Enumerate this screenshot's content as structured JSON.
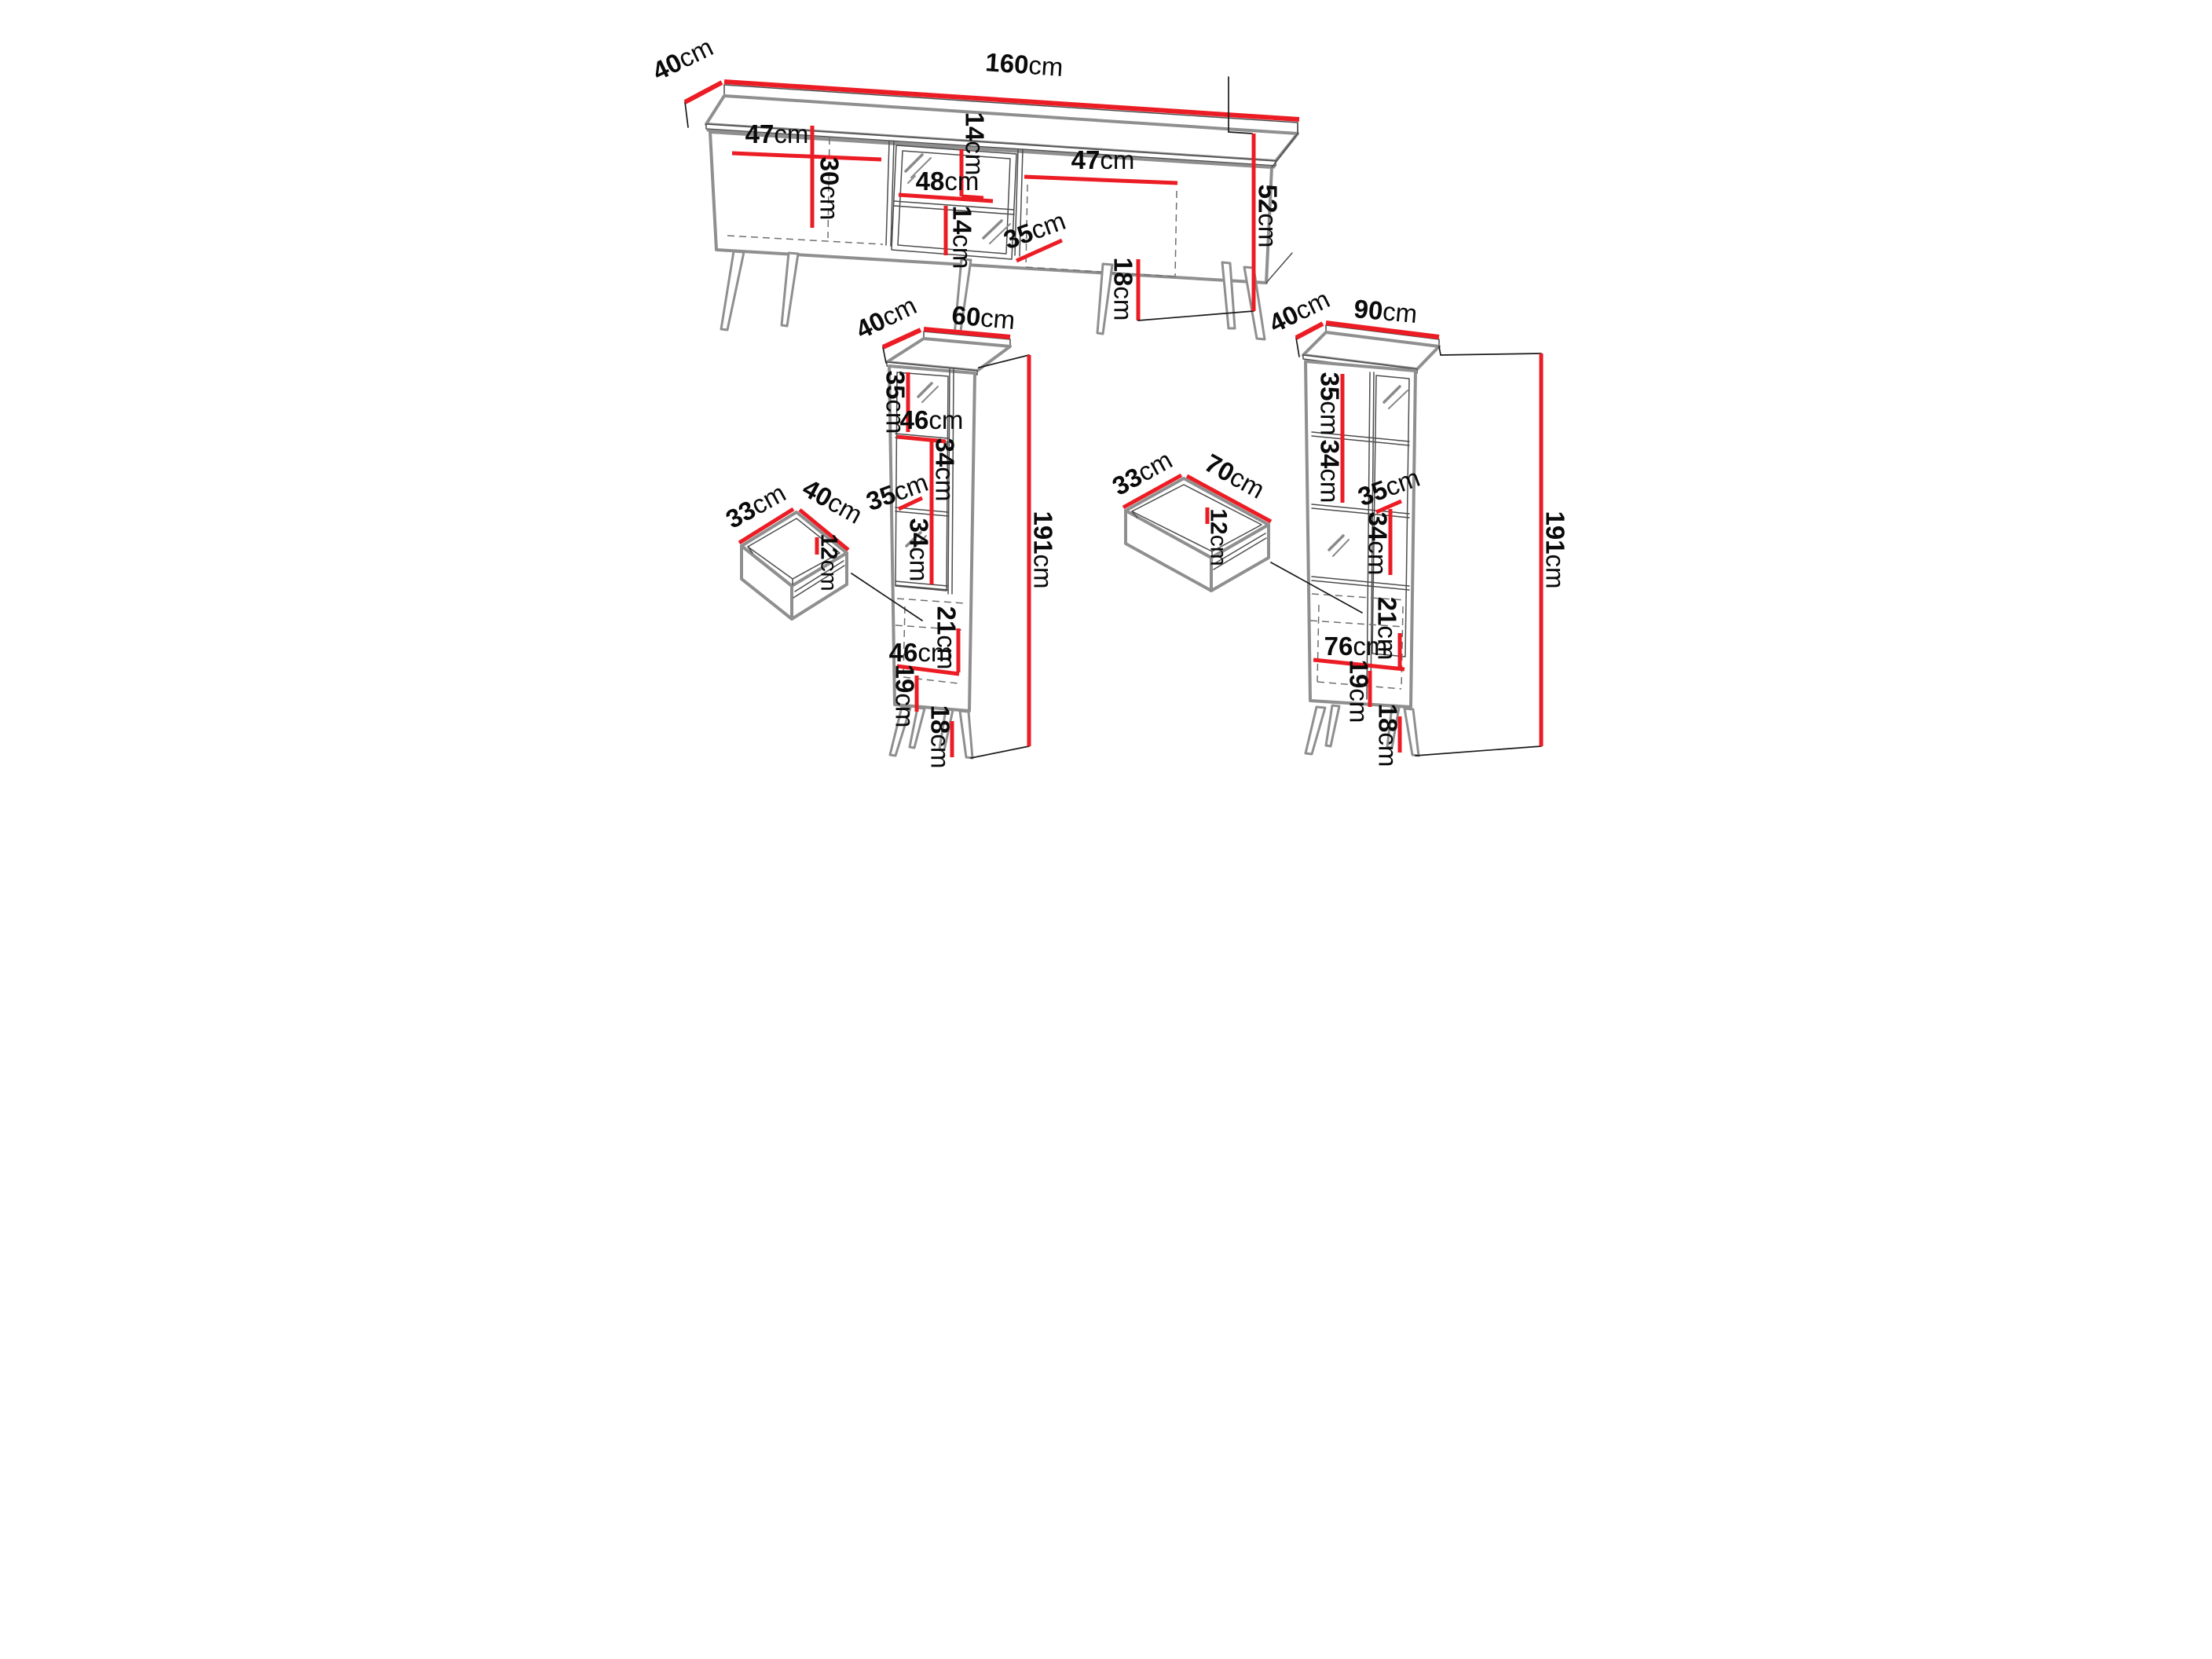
{
  "colors": {
    "dimension_red": "#ec1c24",
    "linework_gray": "#8f8f8f",
    "text_black": "#0a0a0a",
    "background": "#ffffff"
  },
  "labels": {
    "tv": {
      "depth": {
        "num": "40",
        "unit": "cm"
      },
      "width": {
        "num": "160",
        "unit": "cm"
      },
      "left_door_width": {
        "num": "47",
        "unit": "cm"
      },
      "left_door_height": {
        "num": "30",
        "unit": "cm"
      },
      "niche_width": {
        "num": "48",
        "unit": "cm"
      },
      "niche_height_top": {
        "num": "14",
        "unit": "cm"
      },
      "niche_height_bottom": {
        "num": "14",
        "unit": "cm"
      },
      "right_door_width": {
        "num": "47",
        "unit": "cm"
      },
      "interior_depth": {
        "num": "35",
        "unit": "cm"
      },
      "leg_height": {
        "num": "18",
        "unit": "cm"
      },
      "height": {
        "num": "52",
        "unit": "cm"
      }
    },
    "c60": {
      "depth": {
        "num": "40",
        "unit": "cm"
      },
      "width": {
        "num": "60",
        "unit": "cm"
      },
      "section1": {
        "num": "35",
        "unit": "cm"
      },
      "shelf_width": {
        "num": "46",
        "unit": "cm"
      },
      "section2": {
        "num": "34",
        "unit": "cm"
      },
      "shelf_depth": {
        "num": "35",
        "unit": "cm"
      },
      "section3": {
        "num": "34",
        "unit": "cm"
      },
      "drawer_section": {
        "num": "21",
        "unit": "cm"
      },
      "bottom_width": {
        "num": "46",
        "unit": "cm"
      },
      "bottom_section": {
        "num": "19",
        "unit": "cm"
      },
      "leg_height": {
        "num": "18",
        "unit": "cm"
      },
      "height": {
        "num": "191",
        "unit": "cm"
      }
    },
    "d40": {
      "depth": {
        "num": "33",
        "unit": "cm"
      },
      "width": {
        "num": "40",
        "unit": "cm"
      },
      "height": {
        "num": "12",
        "unit": "cm"
      }
    },
    "c90": {
      "depth": {
        "num": "40",
        "unit": "cm"
      },
      "width": {
        "num": "90",
        "unit": "cm"
      },
      "section1": {
        "num": "35",
        "unit": "cm"
      },
      "section2": {
        "num": "34",
        "unit": "cm"
      },
      "shelf_depth": {
        "num": "35",
        "unit": "cm"
      },
      "section3": {
        "num": "34",
        "unit": "cm"
      },
      "drawer_section": {
        "num": "21",
        "unit": "cm"
      },
      "bottom_width": {
        "num": "76",
        "unit": "cm"
      },
      "bottom_section": {
        "num": "19",
        "unit": "cm"
      },
      "leg_height": {
        "num": "18",
        "unit": "cm"
      },
      "height": {
        "num": "191",
        "unit": "cm"
      }
    },
    "d70": {
      "depth": {
        "num": "33",
        "unit": "cm"
      },
      "width": {
        "num": "70",
        "unit": "cm"
      },
      "height": {
        "num": "12",
        "unit": "cm"
      }
    }
  }
}
